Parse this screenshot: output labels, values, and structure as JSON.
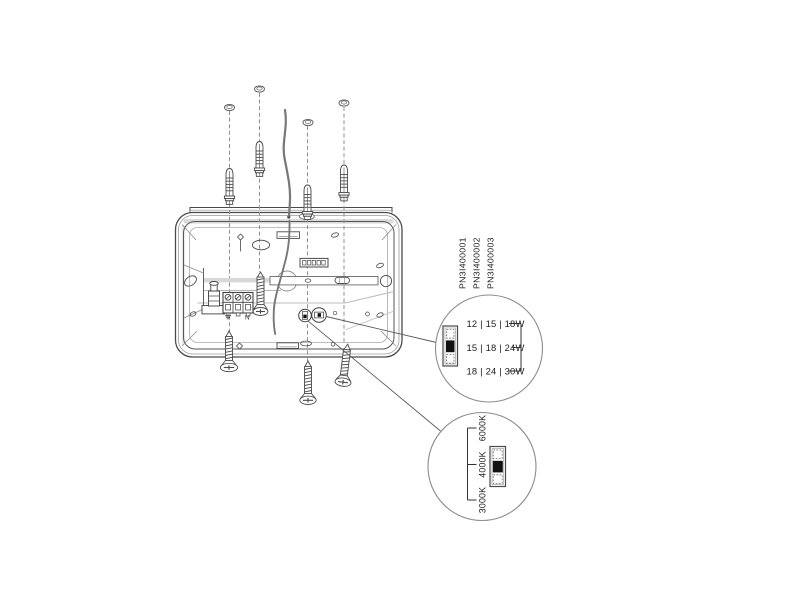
{
  "diagram_title": "luminaire-installation-diagram",
  "part_numbers": [
    "PN3I400001",
    "PN3I400002",
    "PN3I400003"
  ],
  "wattage_callout": {
    "options": [
      "12 | 15 | 18W",
      "15 | 18 | 24W",
      "18 | 24 | 30W"
    ],
    "selected_index": 1,
    "selected": "15 | 18 | 24W"
  },
  "cct_callout": {
    "options": [
      "6000K",
      "4000K",
      "3000K"
    ],
    "selected_index": 1,
    "selected": "4000K"
  },
  "terminal": {
    "neutral_label": "N"
  },
  "colors": {
    "line": "#4a4a4a",
    "muted_line": "#8c8c8c",
    "selected_fill": "#111111",
    "shade": "#d8d8d8",
    "background": "#ffffff"
  }
}
